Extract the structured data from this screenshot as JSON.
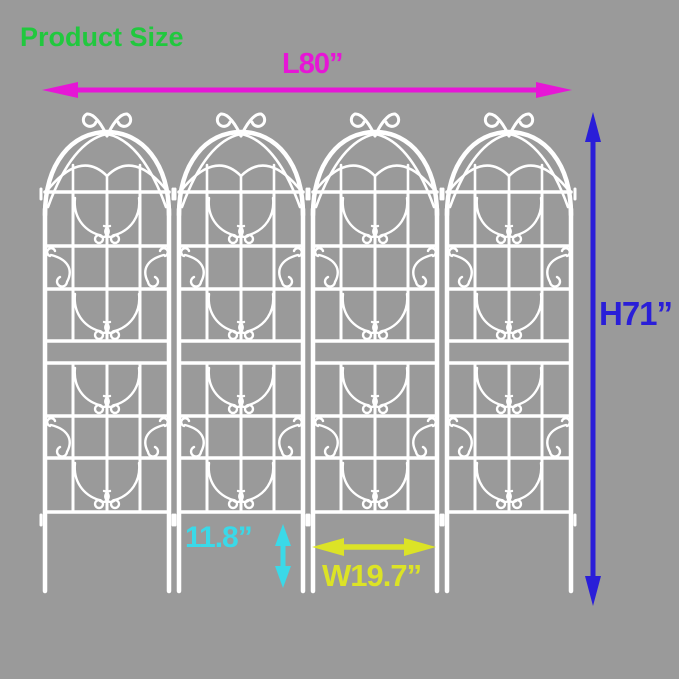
{
  "page": {
    "background": "#9a9a9a"
  },
  "title": {
    "label": "Product Size",
    "color": "#21c83e"
  },
  "colors": {
    "trellis": "#ffffff",
    "length": "#e616d6",
    "height": "#2a1ed8",
    "leg": "#3ad9e8",
    "width": "#dce326"
  },
  "dimensions": {
    "length": {
      "label": "L80”"
    },
    "height": {
      "label": "H71”"
    },
    "leg_height": {
      "label": "11.8”"
    },
    "panel_width": {
      "label": "W19.7”"
    }
  },
  "trellis": {
    "panel_count": 4
  }
}
